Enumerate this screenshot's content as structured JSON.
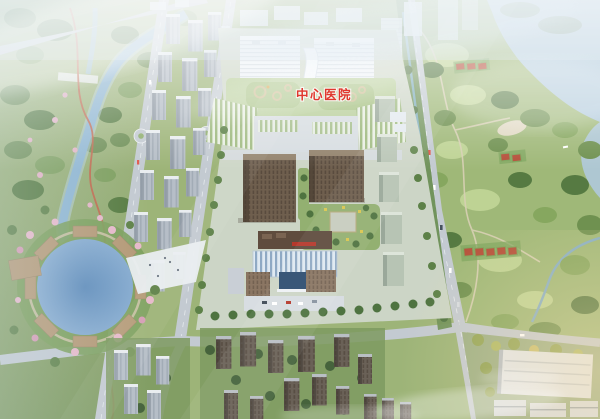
{
  "image": {
    "kind": "aerial-masterplan-rendering",
    "label_overlay": {
      "text": "中心医院",
      "color": "#e0372e"
    }
  },
  "palette": {
    "sky_haze": "#e4edf4",
    "park_green": "#8aa36b",
    "lawn_green": "#c2d698",
    "tree_green": "#5f8248",
    "dark_tree_green": "#4f7340",
    "water_blue": "#8fb6d2",
    "lake_blue": "#afc9db",
    "road_gray": "#c3cad1",
    "building_white": "#edf2f6",
    "podium_roof_green": "#b9cf9b",
    "tower_gray": "#b6bec7",
    "tower_brown": "#6f5f4e",
    "glass_blue": "#8fa9c4",
    "signage_red": "#b5392c",
    "court_red": "#b5503a",
    "deck_tan": "#b59a77",
    "trail_red": "#c2654a",
    "blossom_pink": "#e7b9ca",
    "warm_glow": "#f7dfae"
  },
  "regions": {
    "west_park": "riverside park with winding red trail",
    "west_residential": "rows of residential towers",
    "hospital_campus": "central hospital campus with green podium roofs",
    "brown_towers": "twin brown high-rise blocks with courtyard garden",
    "glass_building": "glass-fronted building with red signage",
    "east_park": "wooded parkland with lawns and tennis courts",
    "lake": "lake in the north-east corner",
    "pond_plaza": "circular pond with timber deck plaza",
    "south_towers": "high-rise cluster along the southern road",
    "industrial": "flat-roofed halls in the south-east corner"
  }
}
